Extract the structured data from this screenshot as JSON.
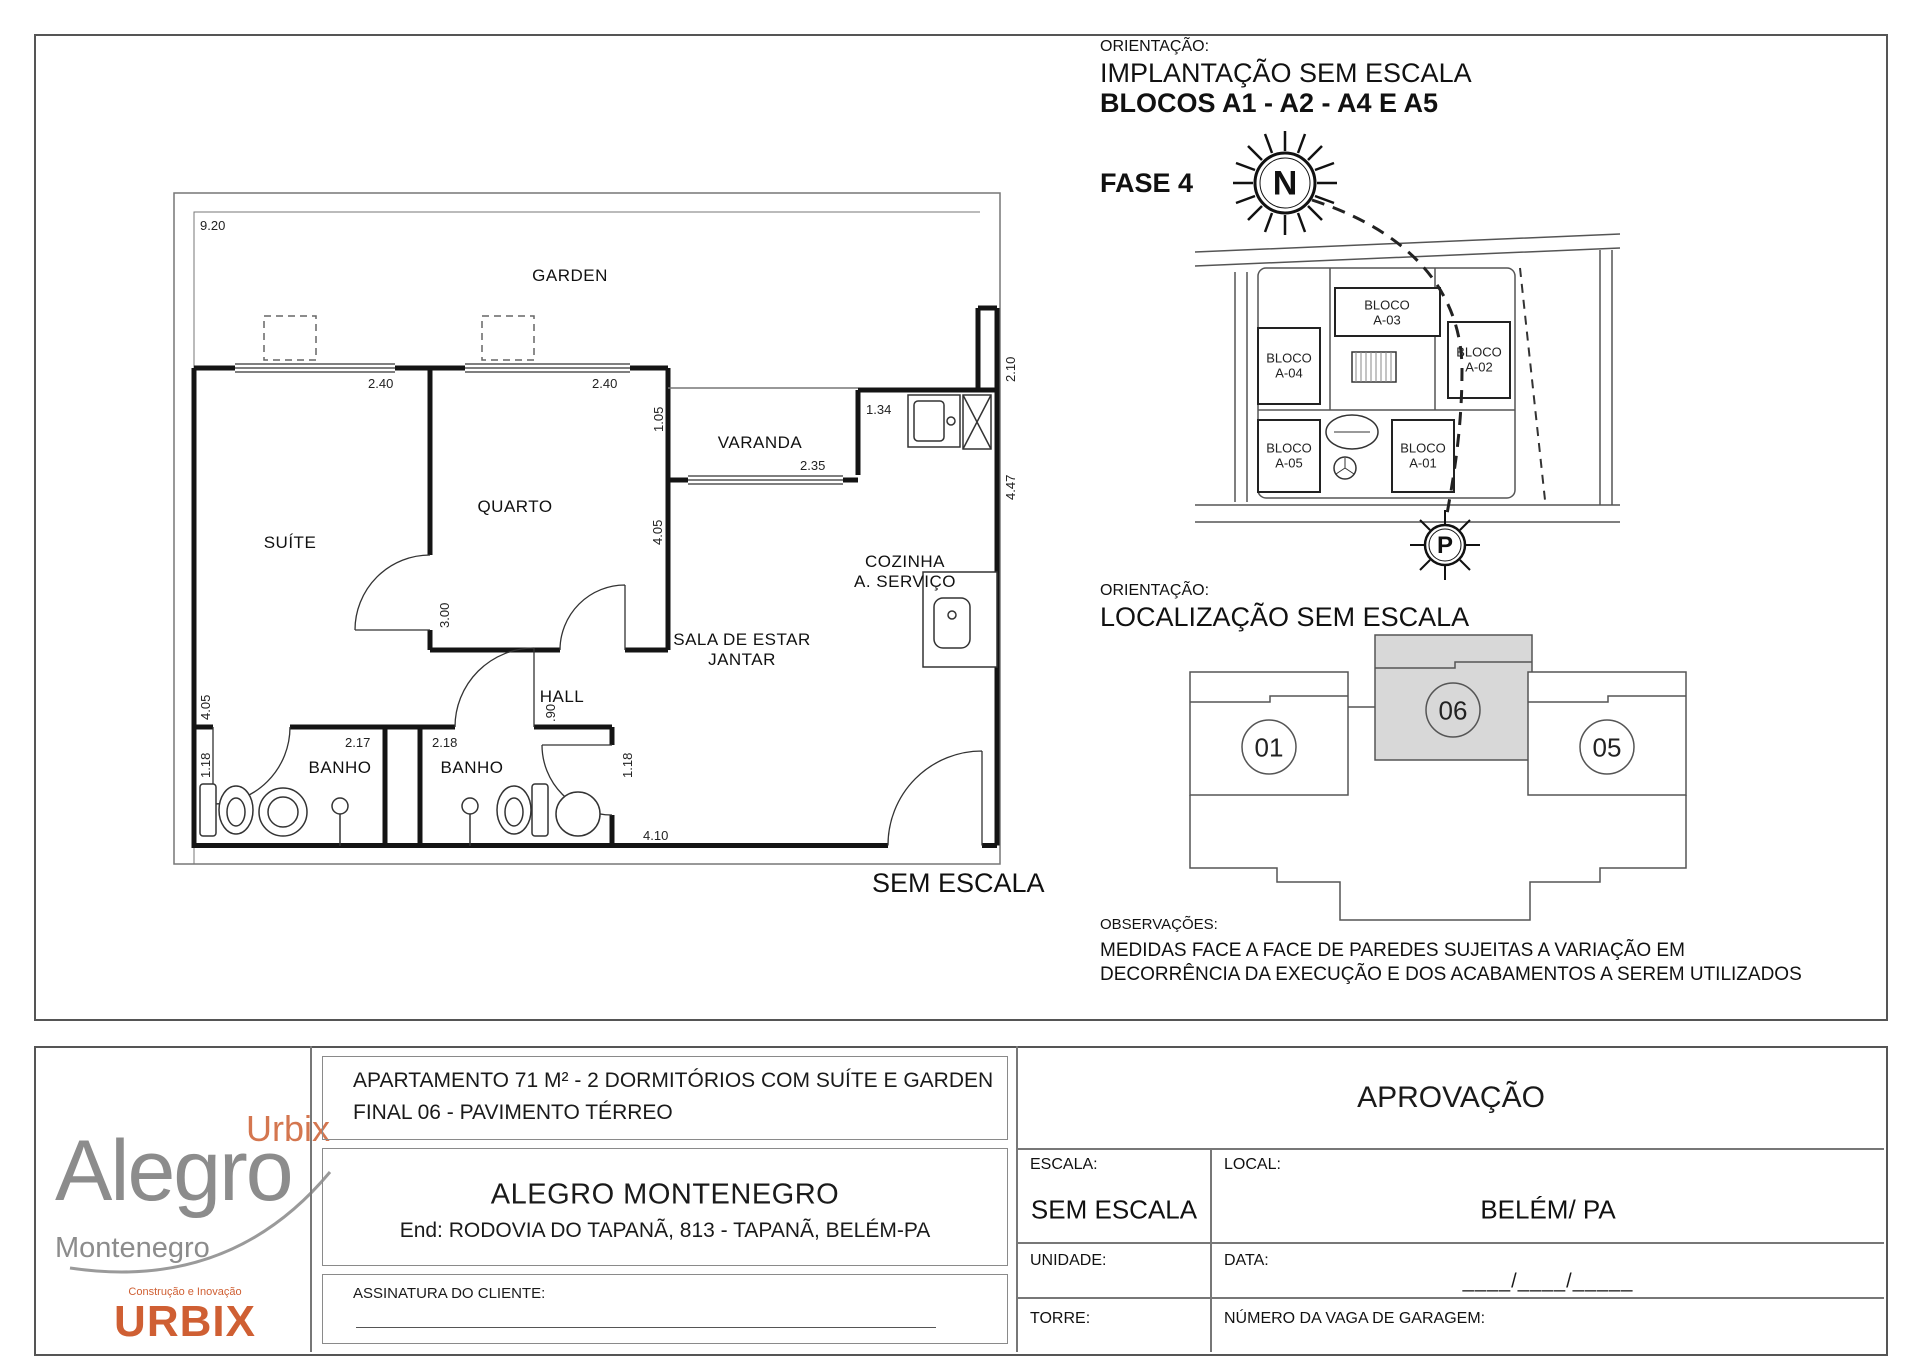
{
  "colors": {
    "accent_orange": "#cf5f33",
    "logo_gray": "#8c8c8c",
    "line_color": "#1a1a1a",
    "highlight_unit_fill": "#d8d8d8"
  },
  "floor_plan": {
    "rooms": {
      "garden": "GARDEN",
      "suite": "SUÍTE",
      "quarto": "QUARTO",
      "varanda": "VARANDA",
      "cozinha_1": "COZINHA",
      "cozinha_2": "A. SERVIÇO",
      "sala_1": "SALA DE ESTAR",
      "sala_2": "JANTAR",
      "hall": "HALL",
      "banho_left": "BANHO",
      "banho_right": "BANHO"
    },
    "dims": {
      "garden_width": "9.20",
      "suite_width": "2.40",
      "quarto_width": "2.40",
      "varanda_height": "1.05",
      "varanda_window": "2.35",
      "kitchen_wall": "1.34",
      "service_height": "2.10",
      "kitchen_height": "4.47",
      "sala_wall": "4.05",
      "suite_wall": "4.05",
      "quarto_wall": "3.00",
      "hall_door": ".90",
      "banho_left_height": "1.18",
      "banho_left_width": "2.17",
      "banho_right_width": "2.18",
      "banho_right_height": "1.18",
      "sala_width": "4.10"
    },
    "scale_note": "SEM ESCALA"
  },
  "implantacao": {
    "label": "ORIENTAÇÃO:",
    "title": "IMPLANTAÇÃO SEM ESCALA",
    "subtitle": "BLOCOS A1 - A2 - A4 E A5",
    "phase": "FASE 4",
    "north": "N",
    "parking": "P",
    "blocks": [
      {
        "name": "BLOCO",
        "code": "A-03"
      },
      {
        "name": "BLOCO",
        "code": "A-04"
      },
      {
        "name": "BLOCO",
        "code": "A-02"
      },
      {
        "name": "BLOCO",
        "code": "A-05"
      },
      {
        "name": "BLOCO",
        "code": "A-01"
      }
    ]
  },
  "localizacao": {
    "label": "ORIENTAÇÃO:",
    "title": "LOCALIZAÇÃO SEM ESCALA",
    "units": [
      "01",
      "06",
      "05"
    ]
  },
  "observacoes": {
    "label": "OBSERVAÇÕES:",
    "line1": "MEDIDAS FACE A FACE DE PAREDES SUJEITAS A VARIAÇÃO EM",
    "line2": "DECORRÊNCIA DA EXECUÇÃO E DOS ACABAMENTOS A SEREM UTILIZADOS"
  },
  "title_block": {
    "logo": {
      "urbix_small": "Urbix",
      "alegro": "Alegro",
      "montenegro": "Montenegro",
      "tagline": "Construção e Inovação",
      "urbix": "URBIX"
    },
    "description_1": "APARTAMENTO 71 M² - 2 DORMITÓRIOS COM SUÍTE E GARDEN",
    "description_2": "FINAL 06 - PAVIMENTO TÉRREO",
    "project": "ALEGRO MONTENEGRO",
    "address": "End: RODOVIA DO TAPANÃ, 813 - TAPANÃ, BELÉM-PA",
    "signature_label": "ASSINATURA DO CLIENTE:",
    "approval": "APROVAÇÃO",
    "scale_label": "ESCALA:",
    "scale_value": "SEM ESCALA",
    "local_label": "LOCAL:",
    "local_value": "BELÉM/ PA",
    "unit_label": "UNIDADE:",
    "date_label": "DATA:",
    "date_slots": "____/____/_____",
    "tower_label": "TORRE:",
    "garage_label": "NÚMERO DA VAGA DE GARAGEM:"
  }
}
